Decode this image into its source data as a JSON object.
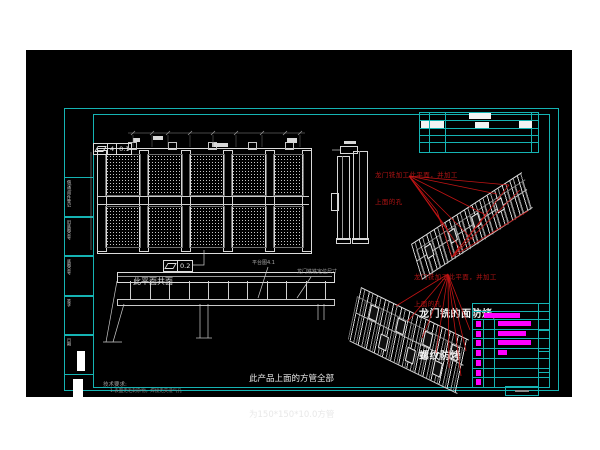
{
  "colors": {
    "canvas_black": "#000000",
    "frame_teal": "#15b3b3",
    "line_white": "#e8e8e8",
    "dim_gray": "#9a9a9a",
    "annotation_red": "#b01414",
    "title_magenta": "#ff00ff"
  },
  "gdt": {
    "top": {
      "symbol": "flatness",
      "datum": "4",
      "tolerance": "0.1"
    },
    "mid": {
      "symbol": "flatness",
      "tolerance": "0.2"
    }
  },
  "annotations": {
    "coplanar": "此平面共面",
    "platform_ref": "平台图4.1",
    "mill_dim": "龙门铣铣定位尺寸",
    "red_note": {
      "line1": "龙门铣加工此平面，并加工",
      "line2": "上面的孔"
    },
    "face_note": {
      "line1": "龙门铣的面防烤,",
      "line2": "螺纹防烤"
    },
    "tube_note": {
      "line1": "此产品上面的方管全部",
      "line2": "为150*150*10.0方管"
    },
    "tech_req": {
      "title": "技术要求:",
      "item1": "1.表面无毛刺杂物，焊接无夹渣气孔"
    }
  },
  "border_strip": {
    "cells": [
      "借(通)用件登记",
      "旧底图总号",
      "底图总号",
      "签字",
      "日期"
    ]
  },
  "title_block": {
    "rows": [
      {
        "mark": true,
        "bar": 33
      },
      {
        "mark": true,
        "bar": 28
      },
      {
        "mark": true,
        "bar": 33
      },
      {
        "mark": true,
        "bar": 9
      },
      {
        "mark": true,
        "bar": 0
      },
      {
        "mark": true,
        "bar": 0
      },
      {
        "mark": true,
        "bar": 0
      }
    ]
  }
}
